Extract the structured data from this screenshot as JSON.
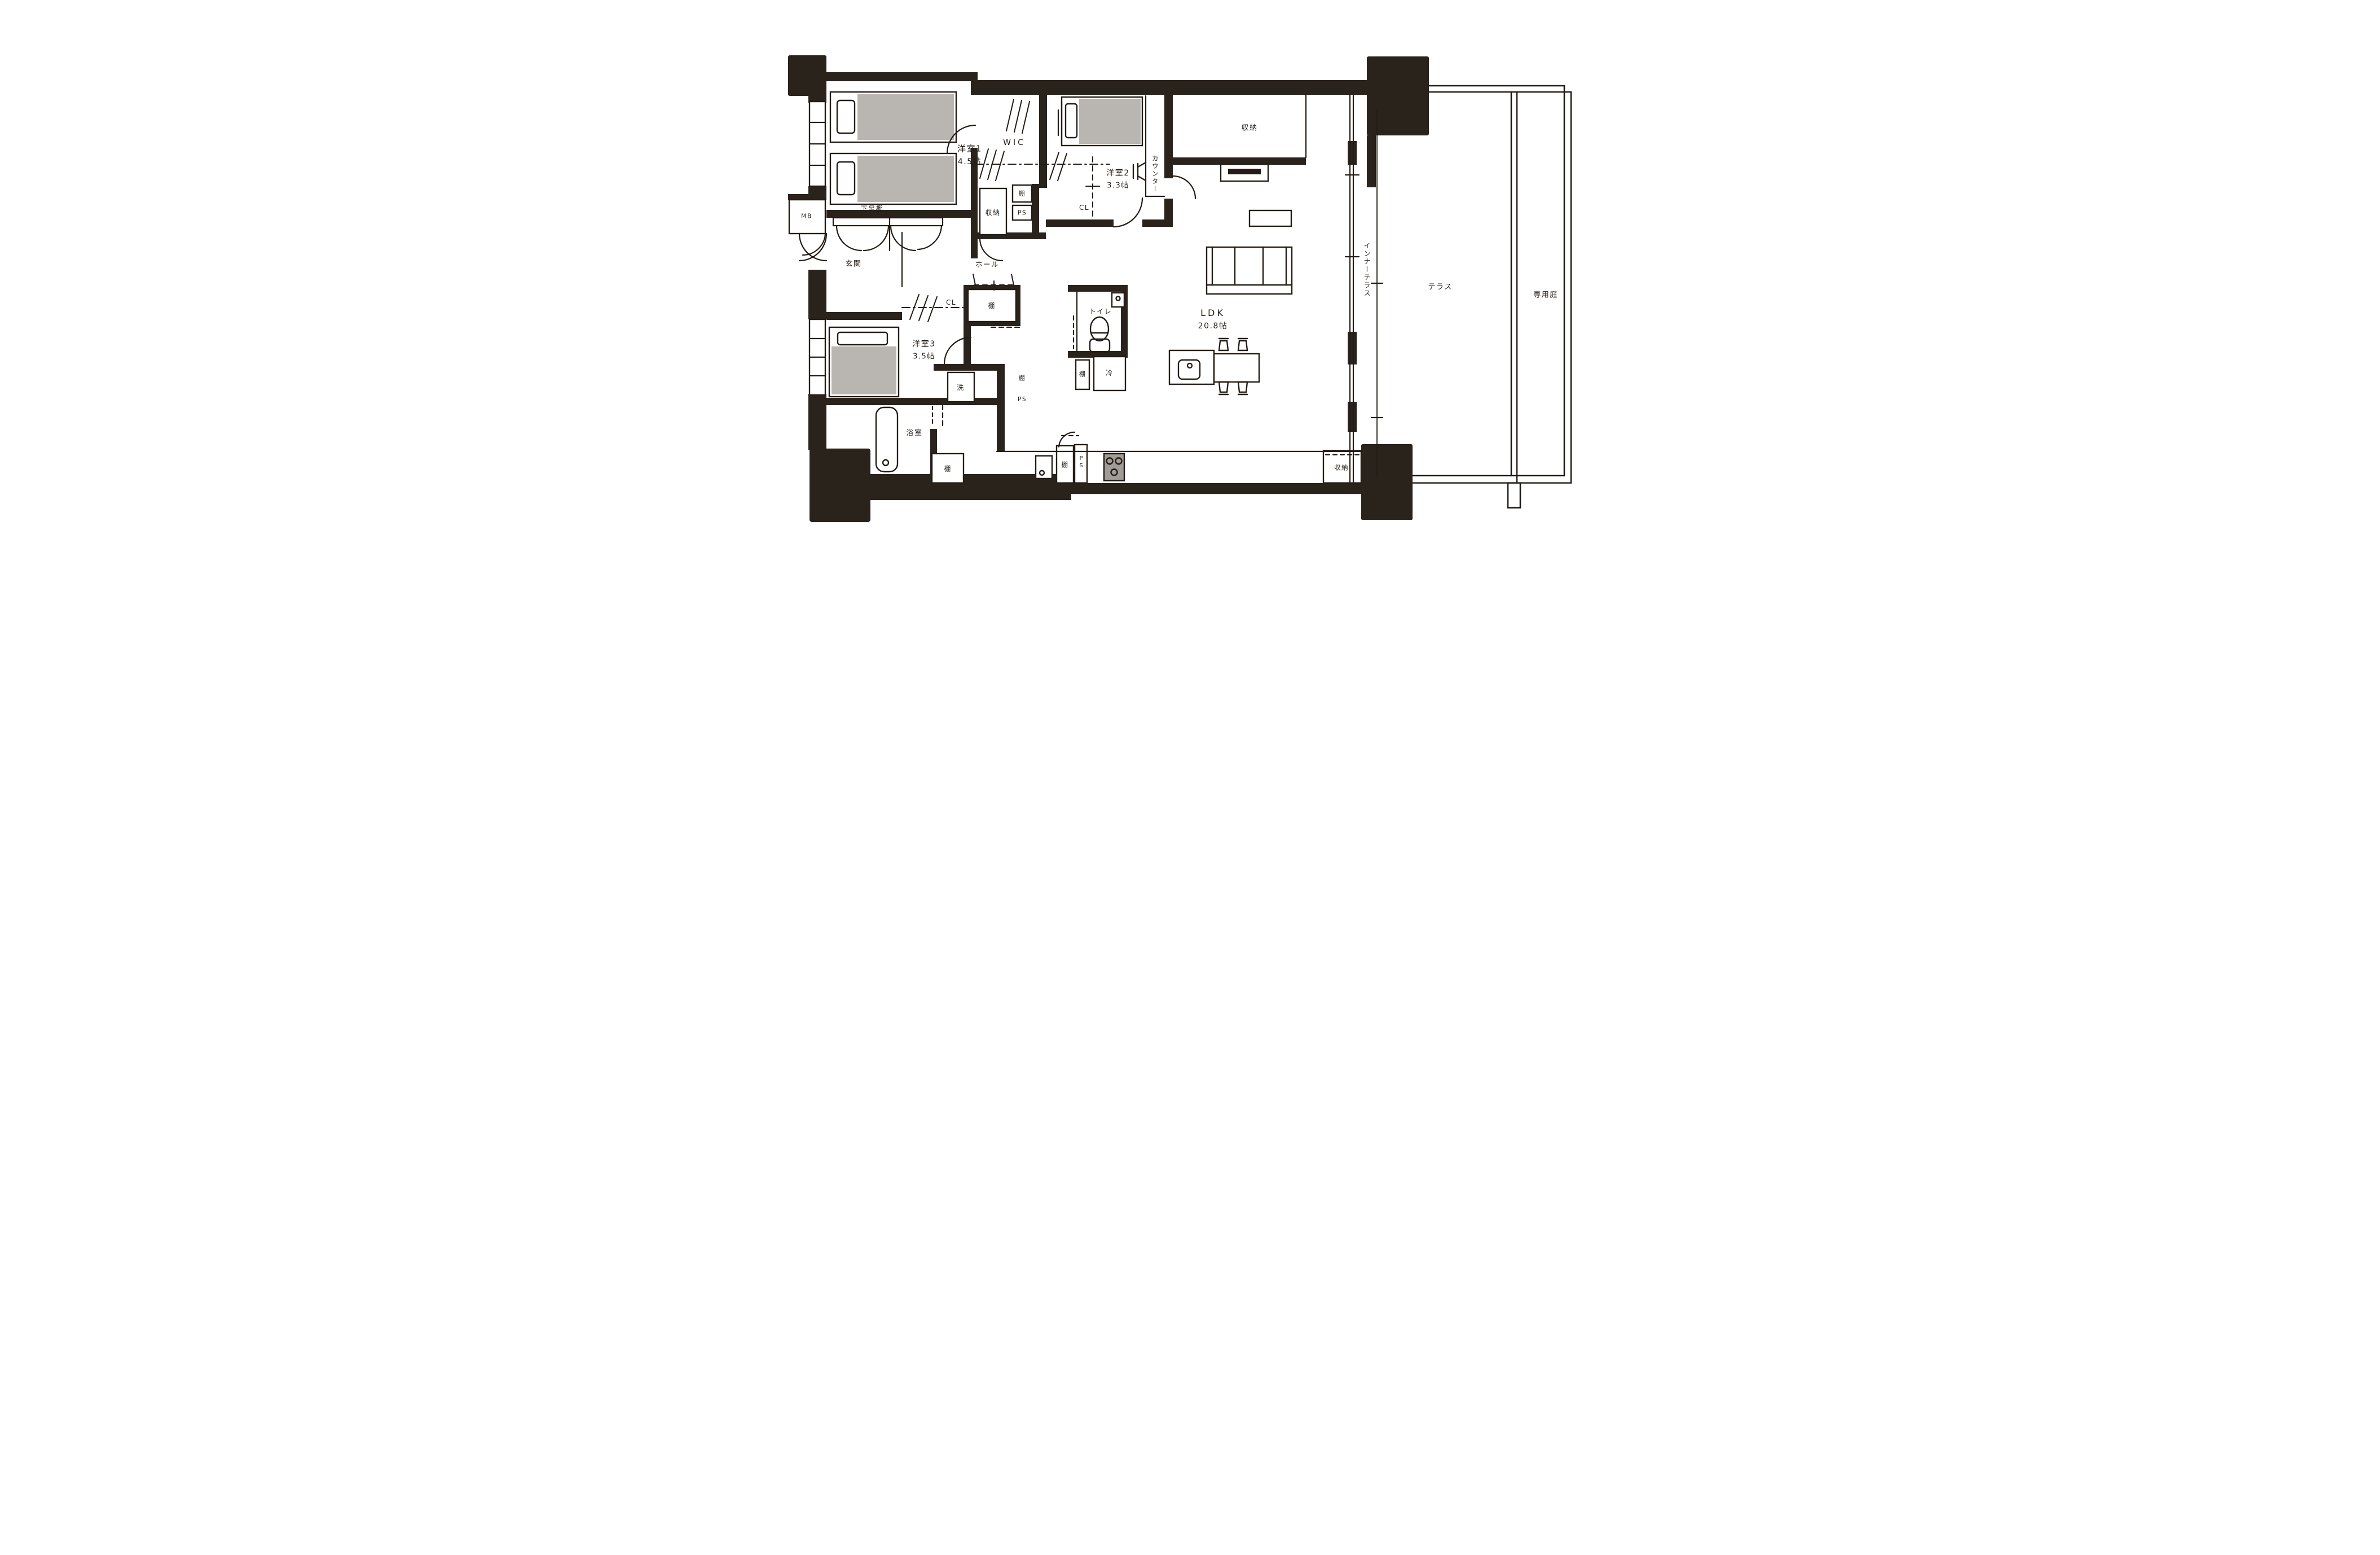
{
  "document": {
    "type": "floor-plan",
    "style": "hand-drawn"
  },
  "colors": {
    "ink": "#241c14",
    "wall": "#2a231c",
    "bed_gray": "#b9b5b1",
    "stove_gray": "#a19c97",
    "paper": "#ffffff"
  },
  "rooms": {
    "yoshitsu1": {
      "name": "洋室1",
      "size": "4.5帖"
    },
    "yoshitsu2": {
      "name": "洋室2",
      "size": "3.3帖"
    },
    "yoshitsu3": {
      "name": "洋室3",
      "size": "3.5帖"
    },
    "ldk": {
      "name": "LDK",
      "size": "20.8帖"
    },
    "wic": {
      "name": "WIC"
    },
    "genkan": {
      "name": "玄関"
    },
    "hall": {
      "name": "ホール"
    },
    "toilet": {
      "name": "トイレ"
    },
    "bath": {
      "name": "浴室"
    },
    "mb": {
      "name": "MB"
    },
    "shoe_shelf": {
      "name": "下足棚"
    },
    "counter": {
      "name": "カウンター"
    },
    "inner_terrace": {
      "name": "インナーテラス"
    },
    "terrace": {
      "name": "テラス"
    },
    "garden": {
      "name": "専用庭"
    }
  },
  "fixtures": {
    "storage": "収納",
    "shelf": "棚",
    "ps": "PS",
    "cl": "CL",
    "washer": "洗",
    "fridge": "冷"
  }
}
